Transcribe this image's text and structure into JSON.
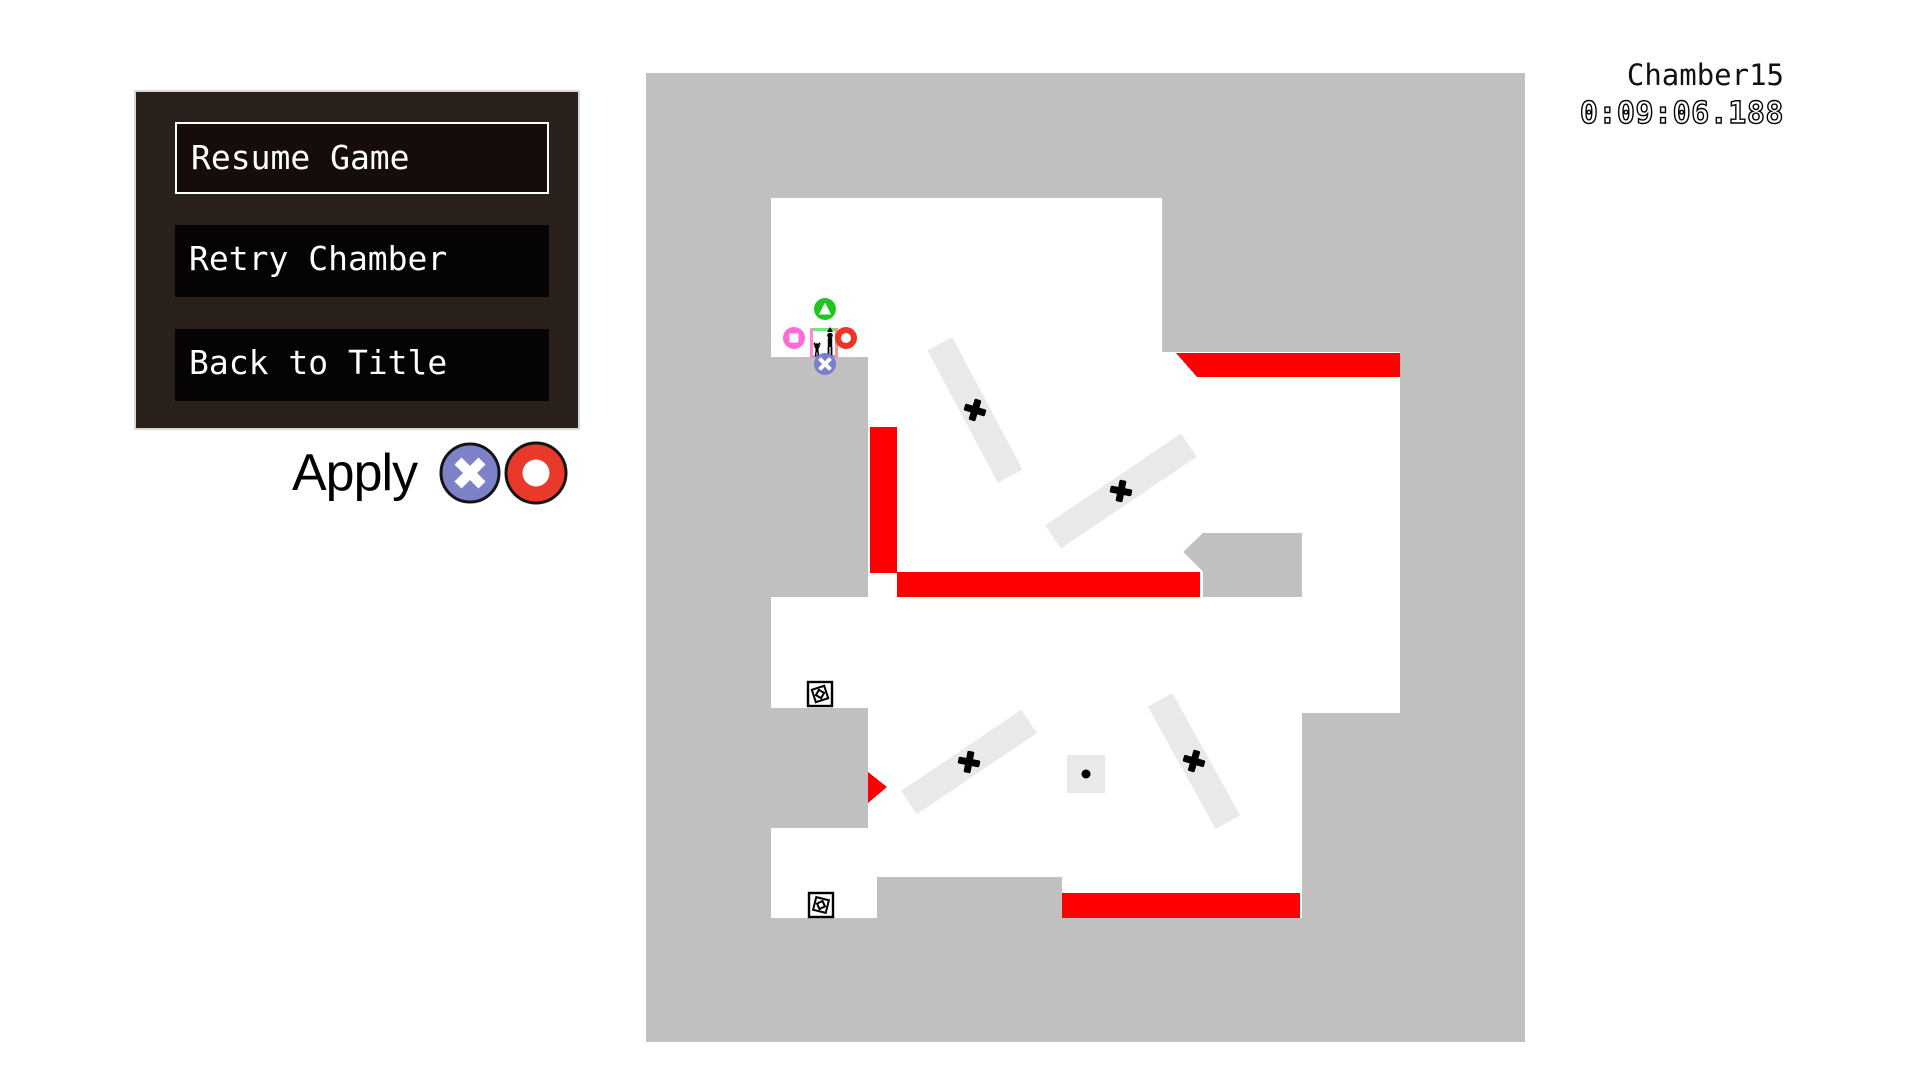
{
  "hud": {
    "chamber": "Chamber15",
    "timer": "0:09:06.188"
  },
  "pause_menu": {
    "items": [
      {
        "label": "Resume Game",
        "selected": true
      },
      {
        "label": "Retry Chamber",
        "selected": false
      },
      {
        "label": "Back to Title",
        "selected": false
      }
    ],
    "apply_label": "Apply",
    "apply_buttons": [
      "cross-button",
      "circle-button"
    ]
  },
  "game": {
    "prompt_buttons": [
      "triangle",
      "square",
      "circle",
      "cross"
    ],
    "items": [
      "spinning-item-box",
      "spinning-item-box"
    ],
    "rotating_platforms": 4,
    "colors": {
      "field_gray": "#c0c0c0",
      "platform_gray": "#e9e9e9",
      "hazard_red": "#ff0000",
      "cross_button_blue": "#7d82c8",
      "circle_button_red": "#e8392a",
      "triangle_button_green": "#21c521",
      "square_button_pink": "#ff6ad5",
      "menu_panel_brown": "#2a201c"
    }
  }
}
